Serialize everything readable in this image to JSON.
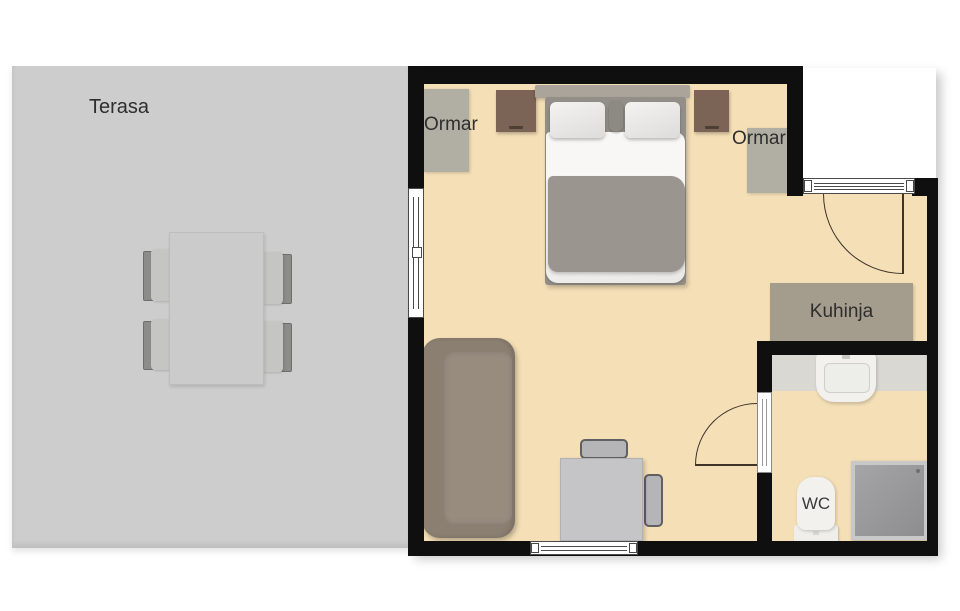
{
  "rooms": {
    "terrace": {
      "label": "Terasa"
    },
    "kitchen": {
      "label": "Kuhinja"
    },
    "toilet": {
      "label": "WC"
    },
    "wardrobe_left": {
      "label": "Ormar"
    },
    "wardrobe_right": {
      "label": "Ormar"
    }
  },
  "furniture": [
    "double-bed",
    "nightstand-left",
    "nightstand-right",
    "wardrobe-left",
    "wardrobe-right",
    "sofa",
    "desk-with-two-chairs",
    "kitchen-counter",
    "bathroom-vanity-sink",
    "shower",
    "toilet",
    "terrace-dining-table",
    "terrace-chairs-x4"
  ],
  "colors": {
    "wall": "#0f0f0f",
    "floor": "#f4dfb6",
    "terrace": "#cdcdcd",
    "table": "#cbcbcb",
    "wardrobe": "#b1afa3",
    "nightstand": "#7b6355",
    "counter": "#a49c8d",
    "vanity": "#d9d8d3",
    "sofa": "#8b7f71",
    "sofa_cushion": "#988c7f",
    "blanket": "#9a968f",
    "label_text": "#2e2e2e"
  }
}
